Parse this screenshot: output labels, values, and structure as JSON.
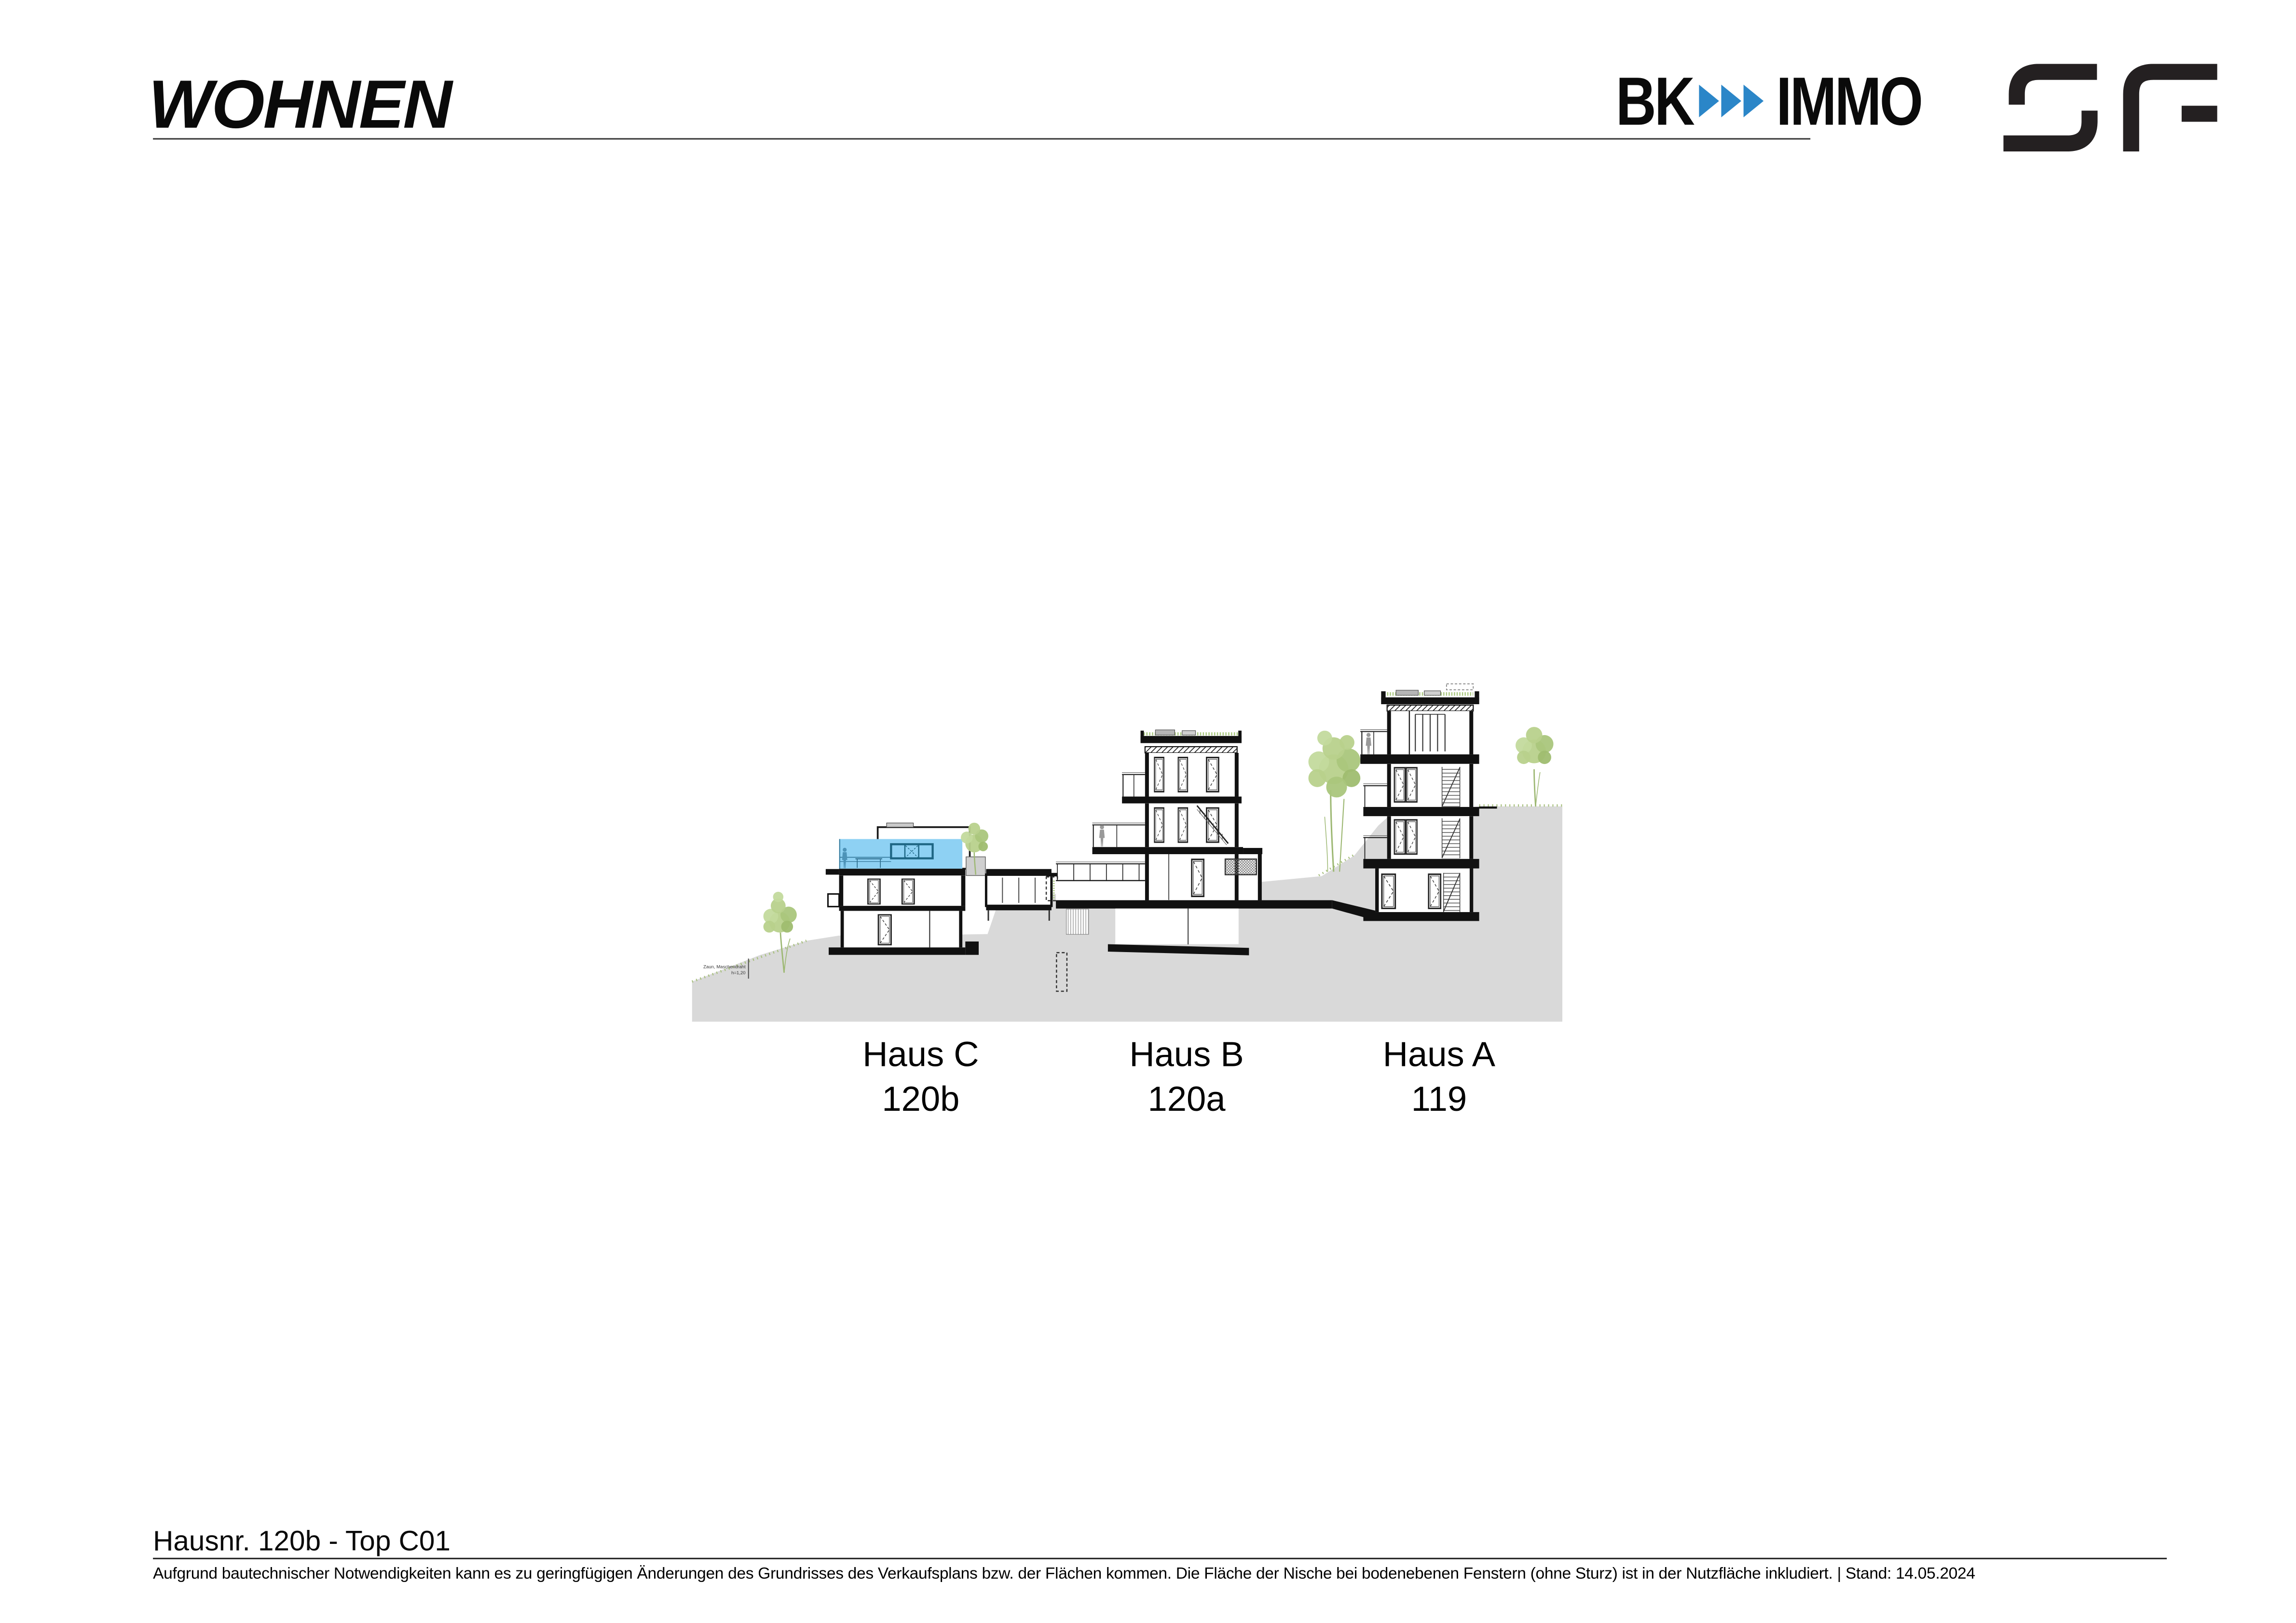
{
  "page": {
    "background": "#ffffff"
  },
  "header": {
    "title": "WOHNEN",
    "brand": {
      "word_left": "BK",
      "word_right": "IMMO",
      "arrow_count": 3,
      "arrow_color": "#2b86c8",
      "text_color": "#0a0a0a"
    },
    "partner_logo_icon": "sf-monogram"
  },
  "drawing": {
    "highlight_color": "#8ed1f3",
    "terrain_color": "#d9d9d9",
    "tree_color": "#b8d18c",
    "line_color": "#111111",
    "fence_label_line1": "Zaun, Maschendraht",
    "fence_label_line2": "h=1,20"
  },
  "site_labels": [
    {
      "name": "Haus C",
      "number": "120b"
    },
    {
      "name": "Haus B",
      "number": "120a"
    },
    {
      "name": "Haus A",
      "number": "119"
    }
  ],
  "footer": {
    "title": "Hausnr. 120b - Top C01",
    "disclaimer": "Aufgrund bautechnischer Notwendigkeiten kann es zu geringfügigen Änderungen des Grundrisses des Verkaufsplans bzw. der Flächen kommen. Die Fläche der Nische bei bodenebenen Fenstern (ohne Sturz) ist in der Nutzfläche inkludiert. | Stand: 14.05.2024"
  }
}
